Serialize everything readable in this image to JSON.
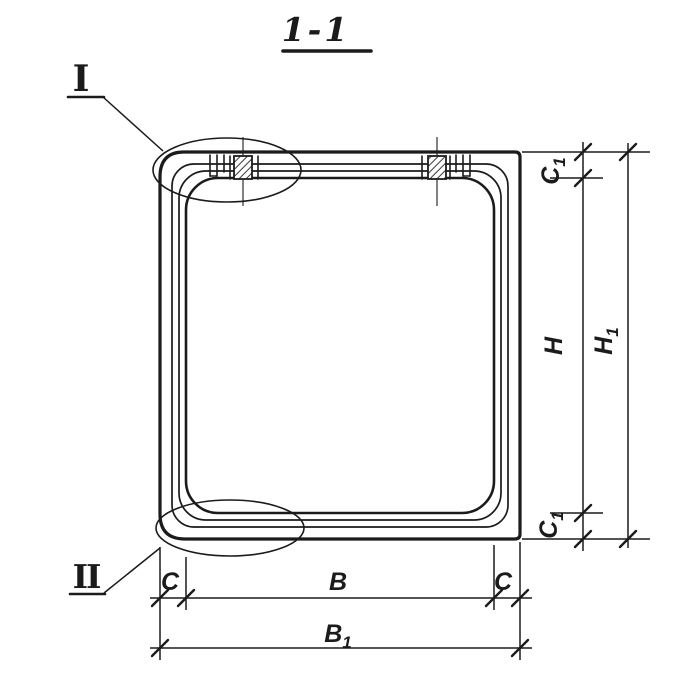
{
  "page": {
    "background": "#ffffff",
    "ink": "#1b1b1b",
    "description": "Technical drawing: cross-section 1-1 of a precast box culvert link with detail callouts and dimension lines"
  },
  "title": {
    "text": "1-1"
  },
  "callouts": {
    "detail_one": {
      "label": "I",
      "position": "top-left-corner"
    },
    "detail_two": {
      "label": "II",
      "position": "bottom-left-corner"
    }
  },
  "dimensions": {
    "right": {
      "c1_top": {
        "base": "C",
        "sub": "1",
        "measures": "top-wall-thickness"
      },
      "h": {
        "base": "H",
        "sub": "",
        "measures": "inner-height"
      },
      "c1_bottom": {
        "base": "C",
        "sub": "1",
        "measures": "bottom-wall-thickness"
      },
      "h1": {
        "base": "H",
        "sub": "1",
        "measures": "overall-height"
      }
    },
    "bottom": {
      "c_left": {
        "base": "C",
        "sub": "",
        "measures": "left-wall-thickness"
      },
      "b": {
        "base": "B",
        "sub": "",
        "measures": "inner-width"
      },
      "c_right": {
        "base": "C",
        "sub": "",
        "measures": "right-wall-thickness"
      },
      "b1": {
        "base": "B",
        "sub": "1",
        "measures": "overall-width"
      }
    }
  }
}
